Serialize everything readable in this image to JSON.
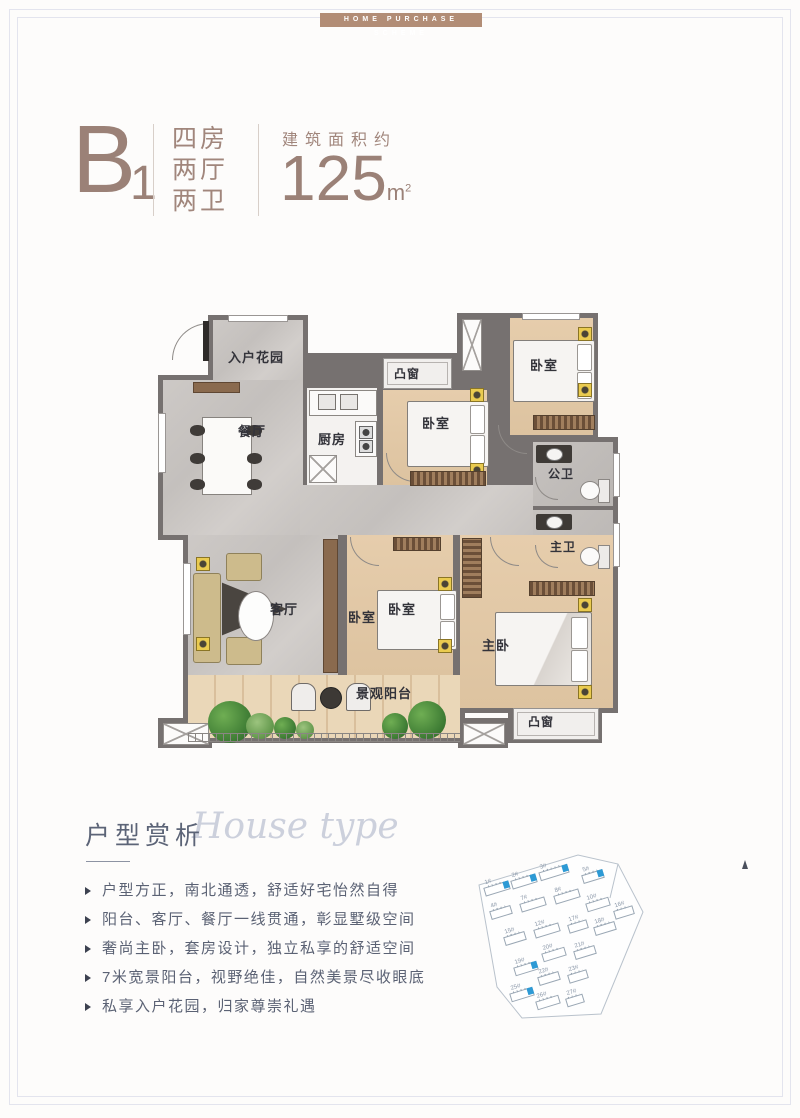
{
  "banner": {
    "text": "HOME PURCHASE SCHEME"
  },
  "unit": {
    "code": "B",
    "code_sub": "1",
    "layout_lines": {
      "0": "四房",
      "1": "两厅",
      "2": "两卫"
    },
    "area_label": "建筑面积约",
    "area_value": "125",
    "area_unit": "m",
    "area_sup": "2"
  },
  "floorplan": {
    "rooms": {
      "entry_garden": "入户花园",
      "dining": "餐厅",
      "kitchen": "厨房",
      "bedroom_north": "卧室",
      "bay_north": "凸窗",
      "bedroom_northeast": "卧室",
      "bath_public": "公卫",
      "bath_master": "主卫",
      "living": "客厅",
      "bedroom_south_a": "卧室",
      "bedroom_south_b": "卧室",
      "master_bedroom": "主卧",
      "balcony": "景观阳台",
      "bay_south": "凸窗"
    }
  },
  "analysis": {
    "title_cn": "户型赏析",
    "title_en": "House type",
    "bullets": [
      "户型方正，南北通透，舒适好宅怡然自得",
      "阳台、客厅、餐厅一线贯通，彰显墅级空间",
      "奢尚主卧，套房设计，独立私享的舒适空间",
      "7米宽景阳台，视野绝佳，自然美景尽收眼底",
      "私享入户花园，归家尊崇礼遇"
    ]
  },
  "siteplan": {
    "buildings": [
      {
        "label": "1#",
        "x": 14,
        "y": 34,
        "w": 24,
        "blue": true
      },
      {
        "label": "2#",
        "x": 41,
        "y": 27,
        "w": 24,
        "blue": true
      },
      {
        "label": "3#",
        "x": 69,
        "y": 18,
        "w": 28,
        "blue": true
      },
      {
        "label": "5#",
        "x": 112,
        "y": 22,
        "w": 20,
        "blue": true
      },
      {
        "label": "4#",
        "x": 20,
        "y": 58,
        "w": 20,
        "blue": false
      },
      {
        "label": "7#",
        "x": 50,
        "y": 50,
        "w": 24,
        "blue": false
      },
      {
        "label": "8#",
        "x": 84,
        "y": 42,
        "w": 24,
        "blue": false
      },
      {
        "label": "10#",
        "x": 116,
        "y": 50,
        "w": 22,
        "blue": false
      },
      {
        "label": "16#",
        "x": 144,
        "y": 58,
        "w": 18,
        "blue": false
      },
      {
        "label": "15#",
        "x": 34,
        "y": 84,
        "w": 20,
        "blue": false
      },
      {
        "label": "12#",
        "x": 64,
        "y": 76,
        "w": 24,
        "blue": false
      },
      {
        "label": "17#",
        "x": 98,
        "y": 72,
        "w": 18,
        "blue": false
      },
      {
        "label": "18#",
        "x": 124,
        "y": 74,
        "w": 20,
        "blue": false
      },
      {
        "label": "20#",
        "x": 72,
        "y": 100,
        "w": 22,
        "blue": false
      },
      {
        "label": "21#",
        "x": 104,
        "y": 98,
        "w": 20,
        "blue": false
      },
      {
        "label": "19#",
        "x": 44,
        "y": 114,
        "w": 22,
        "blue": true
      },
      {
        "label": "22#",
        "x": 68,
        "y": 124,
        "w": 20,
        "blue": false
      },
      {
        "label": "23#",
        "x": 98,
        "y": 122,
        "w": 18,
        "blue": false
      },
      {
        "label": "25#",
        "x": 40,
        "y": 140,
        "w": 22,
        "blue": true
      },
      {
        "label": "26#",
        "x": 66,
        "y": 148,
        "w": 22,
        "blue": false
      },
      {
        "label": "27#",
        "x": 96,
        "y": 146,
        "w": 16,
        "blue": false
      }
    ]
  },
  "colors": {
    "brand_mauve": "#9b8177",
    "banner_tan": "#b28d76",
    "highlight_blue": "#2d9ad5",
    "wall_gray": "#767170",
    "wood_floor": "#e3caa9",
    "marble_floor": "#c9c5c2",
    "text_blue_gray": "#5b6274"
  }
}
